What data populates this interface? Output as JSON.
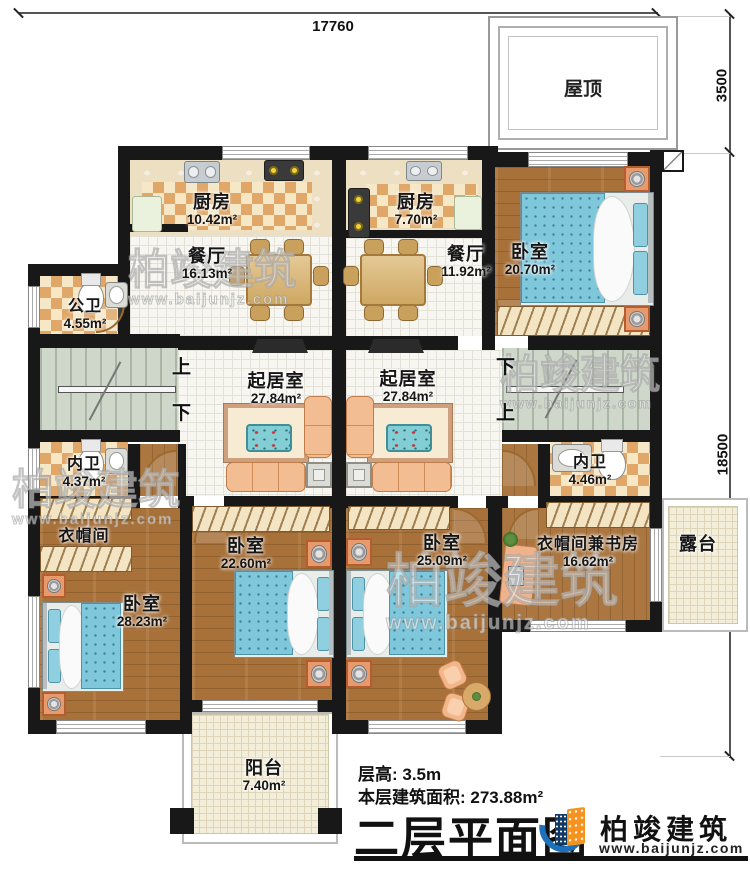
{
  "title_block": {
    "floor_height": "层高: 3.5m",
    "floor_area": "本层建筑面积: 273.88m²",
    "plan_title": "二层平面图"
  },
  "brand": {
    "name": "柏竣建筑",
    "url": "www.baijunjz.com"
  },
  "watermark": {
    "name": "柏竣建筑",
    "url": "www.baijunjz.com"
  },
  "dimensions": {
    "top_width": "17760",
    "right_roof": "3500",
    "right_main": "18500"
  },
  "roof": {
    "label": "屋顶"
  },
  "stairs": {
    "up": "上",
    "down": "下"
  },
  "rooms": {
    "kitchen_left": {
      "label": "厨房",
      "area": "10.42m²"
    },
    "dining_left": {
      "label": "餐厅",
      "area": "16.13m²"
    },
    "kitchen_right": {
      "label": "厨房",
      "area": "7.70m²"
    },
    "dining_right": {
      "label": "餐厅",
      "area": "11.92m²"
    },
    "bedroom_top_right": {
      "label": "卧室",
      "area": "20.70m²"
    },
    "public_bath": {
      "label": "公卫",
      "area": "4.55m²"
    },
    "living_left": {
      "label": "起居室",
      "area": "27.84m²"
    },
    "living_right": {
      "label": "起居室",
      "area": "27.84m²"
    },
    "inner_bath_left": {
      "label": "内卫",
      "area": "4.37m²"
    },
    "inner_bath_right": {
      "label": "内卫",
      "area": "4.46m²"
    },
    "cloakroom": {
      "label": "衣帽间",
      "area": ""
    },
    "bedroom_bottom_left": {
      "label": "卧室",
      "area": "28.23m²"
    },
    "bedroom_bottom_mid": {
      "label": "卧室",
      "area": "22.60m²"
    },
    "bedroom_bottom_right": {
      "label": "卧室",
      "area": "25.09m²"
    },
    "cloak_study": {
      "label": "衣帽间兼书房",
      "area": "16.62m²"
    },
    "terrace": {
      "label": "露台",
      "area": ""
    },
    "balcony": {
      "label": "阳台",
      "area": "7.40m²"
    }
  },
  "colors": {
    "wall": "#181818",
    "wood_floor": "#a8713a",
    "checker_tile": "#e0a768",
    "stair": "#ced7c9",
    "bed_teal": "#7fc7da",
    "logo_blue": "#1e71b8",
    "logo_orange": "#f6921e"
  }
}
